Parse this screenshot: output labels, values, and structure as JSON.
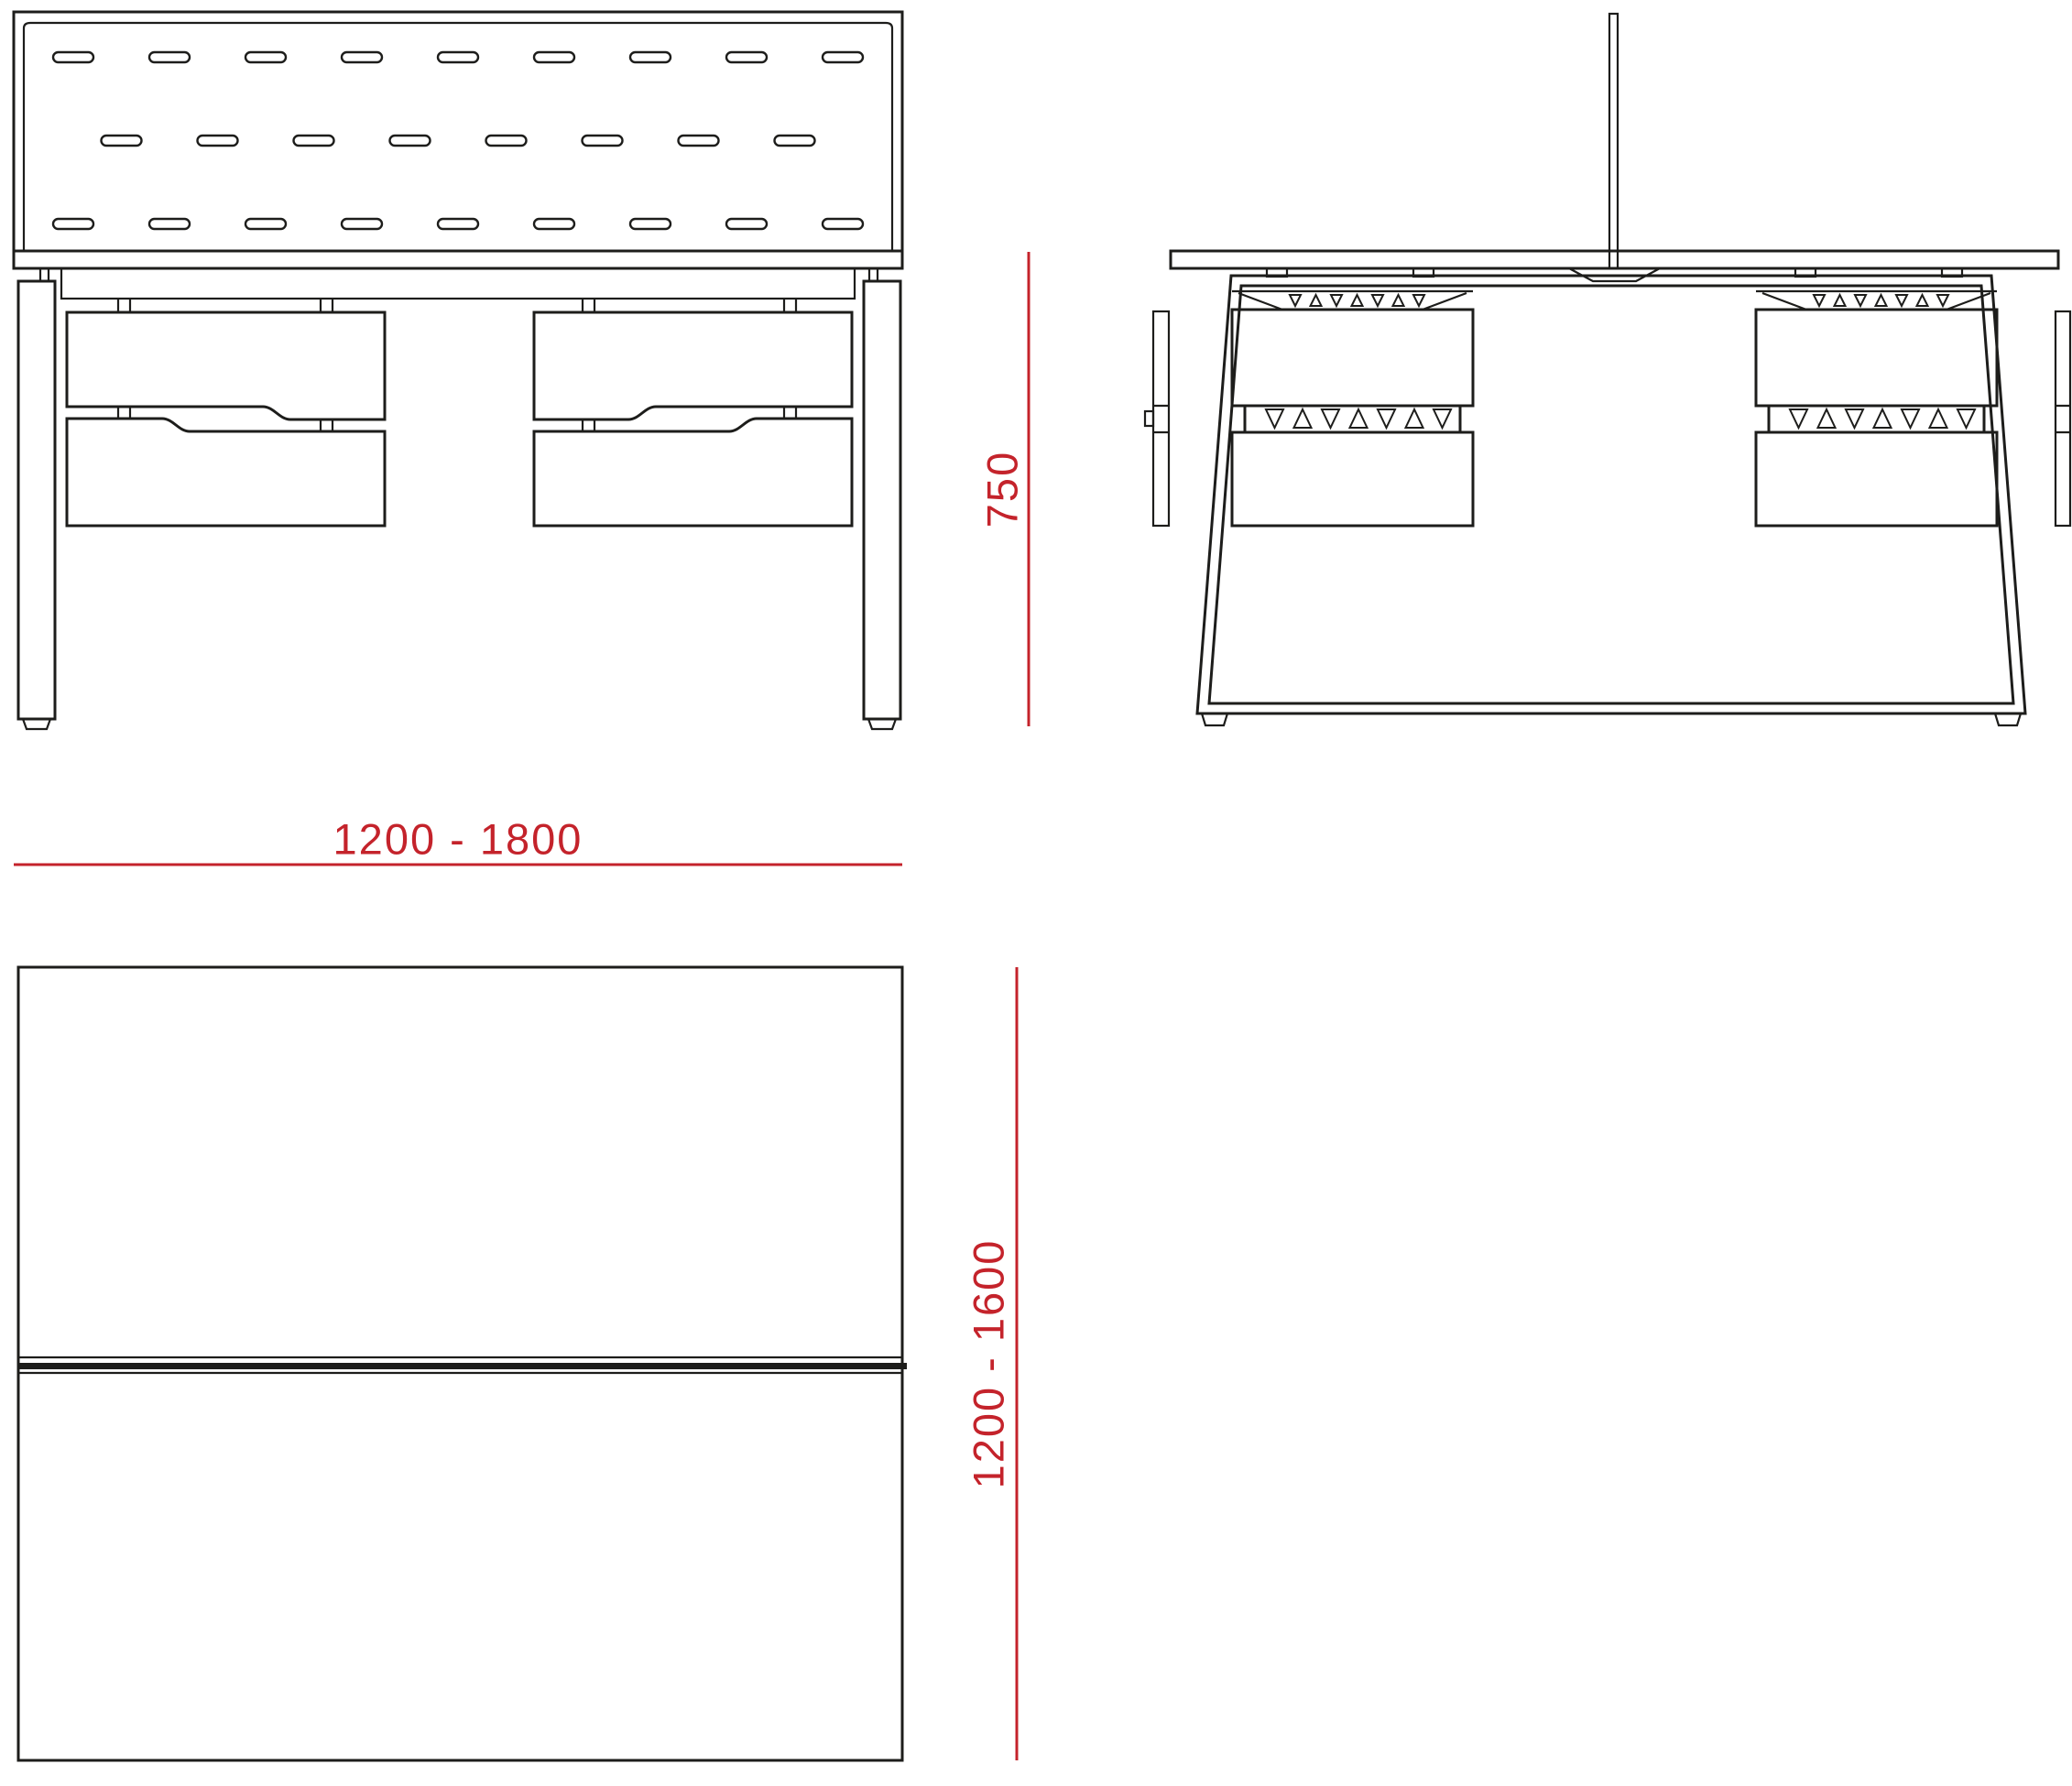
{
  "colors": {
    "ink": "#1d1d1b",
    "red": "#c4232b",
    "background": "#ffffff"
  },
  "drawing": {
    "type": "furniture technical drawing, bench desk with screen and drawer pedestals",
    "dimensions": {
      "desk_height": "750",
      "desk_width_range": "1200 - 1800",
      "desk_depth_range": "1200 - 1600"
    }
  }
}
